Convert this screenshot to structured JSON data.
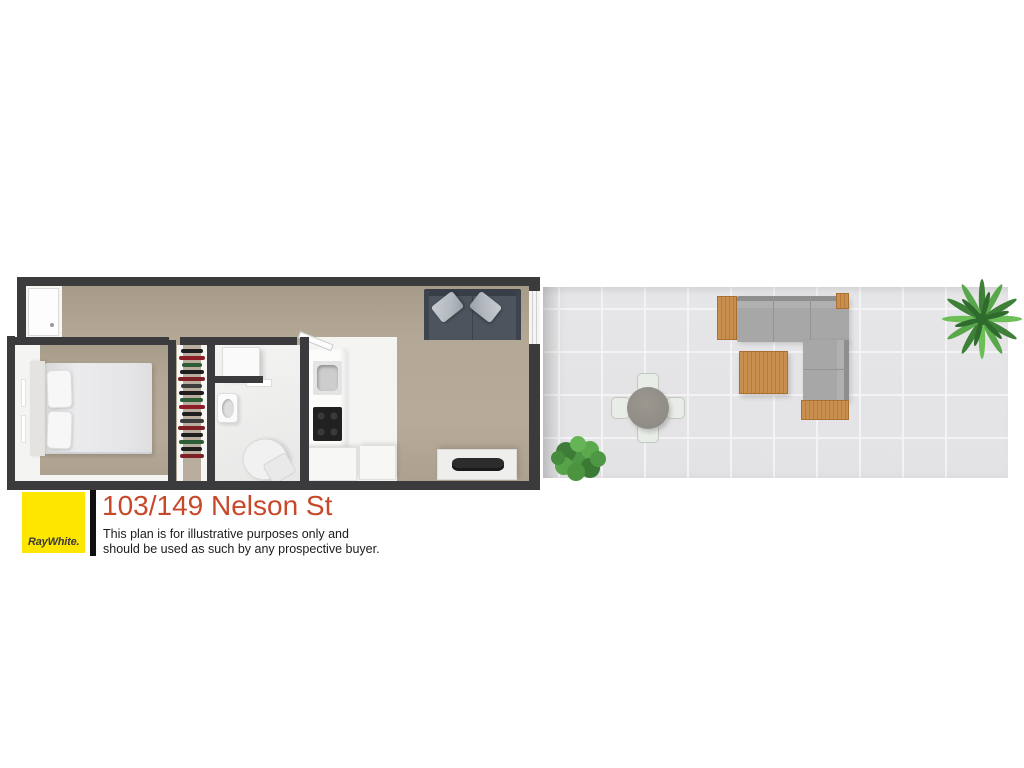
{
  "branding": {
    "agency_logo_text": "RayWhite.",
    "title": "103/149 Nelson St",
    "disclaimer_line1": "This plan is for illustrative purposes only and",
    "disclaimer_line2": "should be used as such by any prospective buyer."
  },
  "colors": {
    "brand-yellow": "#FFE600",
    "title-red": "#C7492A",
    "wall": "#3B3B3D",
    "carpet": "#B3A795",
    "carpet-dark": "#A69A88",
    "white-floor": "#F4F4F3",
    "tile": "#E3E3E5",
    "tile-line": "#F3F3F5",
    "sofa-dark": "#4D545E",
    "sofa-back": "#383E47",
    "sofa-pillow": "#B3B8BF",
    "outdoor-cushion": "#A7A7A7",
    "outdoor-back": "#8E8E8E",
    "wood": "#C98F4F",
    "wood-dark": "#B57C3E",
    "plant": "#4F9847",
    "table-top": "#8F8C86",
    "cooktop": "#212121",
    "tv": "#2C2C2C",
    "clothes-1": "#1E1E1E",
    "clothes-2": "#7E2026",
    "clothes-3": "#2C5D37",
    "clothes-4": "#3C3C3C",
    "clothes-5": "#8F1D28"
  }
}
